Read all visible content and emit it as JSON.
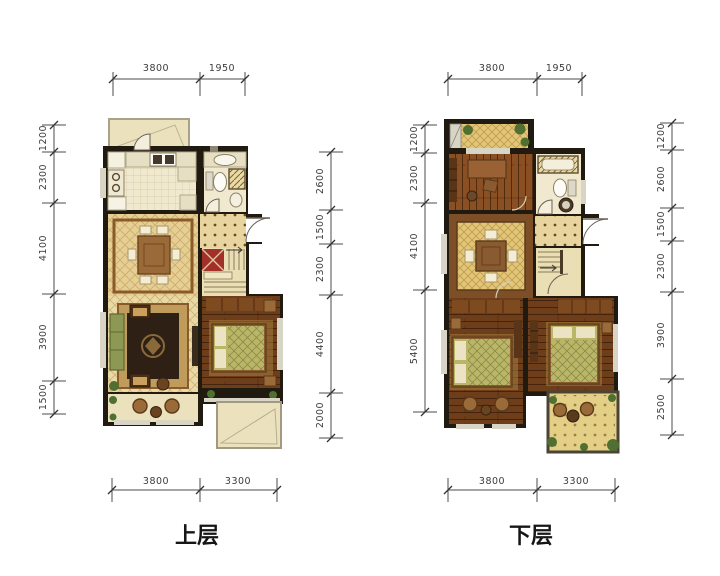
{
  "title": "户型图 Floor Plans",
  "floors": [
    {
      "id": "upper",
      "label": "上层",
      "dims_top": [
        "3800",
        "1950"
      ],
      "dims_bottom": [
        "3800",
        "3300"
      ],
      "dims_left": [
        "1200",
        "2300",
        "4100",
        "3900",
        "1500"
      ],
      "dims_right": [
        "2600",
        "1500",
        "2300",
        "4400",
        "2000"
      ]
    },
    {
      "id": "lower",
      "label": "下层",
      "dims_top": [
        "3800",
        "1950"
      ],
      "dims_bottom": [
        "3800",
        "3300"
      ],
      "dims_left": [
        "1200",
        "2300",
        "4100",
        "5400"
      ],
      "dims_right": [
        "1200",
        "2600",
        "1500",
        "2300",
        "3900",
        "2500"
      ]
    }
  ],
  "colors": {
    "wall": "#211a10",
    "tile_cream": "#f1e9cf",
    "tile_diamond": "#e5cf94",
    "tile_living": "#e9d9a6",
    "tile_gold": "#e2c678",
    "tile_hall": "#e7d49e",
    "stair_floor": "#eadfb4",
    "stair_red": "#a33028",
    "wood": "#6e3d1a",
    "wood_light": "#8a4f22",
    "balcony": "#ebe2bd",
    "terrace": "#e4cf86",
    "plant": "#4f7030",
    "rug_border": "#bf9c5c",
    "rug_center": "#2e2014",
    "bed_blanket": "#b9b668",
    "pillow": "#ece2c4",
    "wardrobe": "#7e4a20",
    "dim_line": "#4b4b4b",
    "dim_text": "#3c3c3c",
    "window": "#d8d4c6"
  }
}
